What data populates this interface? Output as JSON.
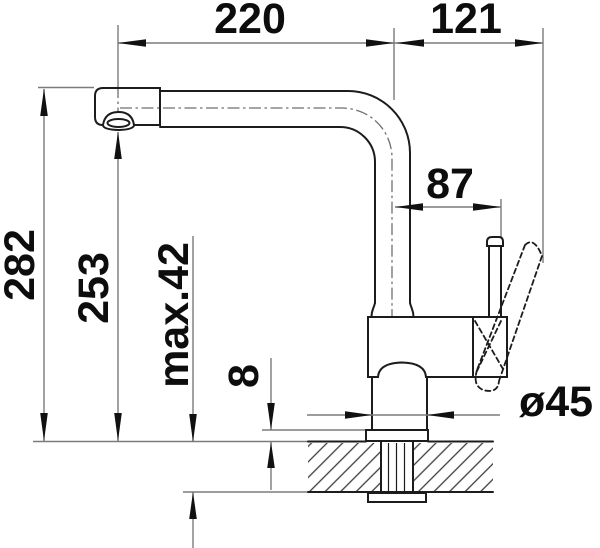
{
  "drawing": {
    "dim": {
      "spout_reach": "220",
      "handle_reach": "121",
      "lever_offset": "87",
      "overall_height": "282",
      "outlet_height": "253",
      "max_mount_thickness": "max.42",
      "flange_height": "8",
      "base_diameter": "ø45"
    },
    "colors": {
      "outline": "#1c1c1c",
      "thin_line": "#7b7b7b",
      "text": "#0d0d0d",
      "background": "#ffffff"
    }
  }
}
